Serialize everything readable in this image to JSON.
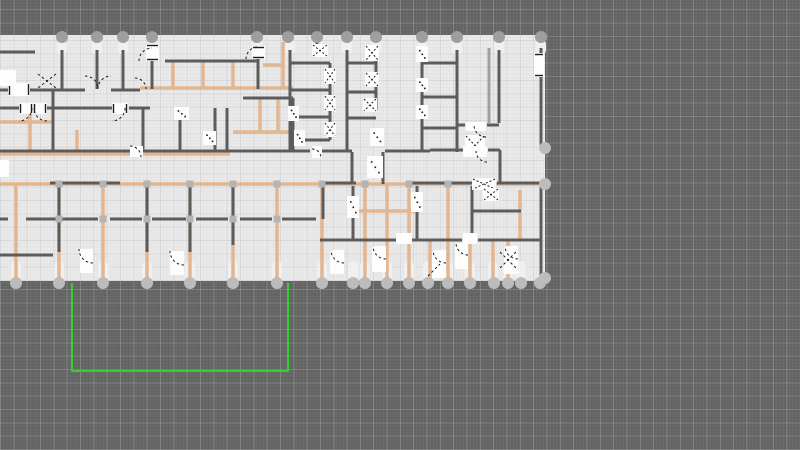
{
  "app": {
    "name": "floor-plan-editor",
    "view": "plan-canvas"
  },
  "canvas": {
    "width": 800,
    "height": 450,
    "background": "#636363",
    "grid": {
      "minor_step_px": 3.33,
      "major_step_px": 13.33,
      "minor_color": "rgba(255,255,255,0.04)",
      "major_color": "rgba(255,255,255,0.16)"
    }
  },
  "slab": {
    "x": 0,
    "y": 35,
    "width": 545,
    "height": 246,
    "fill": "#eaeaea"
  },
  "palette": {
    "wall_dark": "#5c5c5c",
    "wall_light": "#a0a0a0",
    "wall_tan": "#e2b690",
    "door_fill": "#fdfdfd",
    "door_mark": "#1c1c1c",
    "node_top": "#9e9e9e",
    "node_bottom": "#bcbcbc",
    "cap_fill": "#f0f0f0",
    "joint_fill": "#b4b4b4",
    "selection_green": "#2fd12f"
  },
  "geometry": {
    "walls_dark": [
      [
        62,
        50,
        62,
        89
      ],
      [
        97,
        50,
        97,
        89
      ],
      [
        123,
        50,
        123,
        89
      ],
      [
        152,
        60,
        152,
        89
      ],
      [
        165,
        61,
        258,
        61
      ],
      [
        258,
        57,
        258,
        89
      ],
      [
        0,
        52,
        35,
        52
      ],
      [
        290,
        50,
        290,
        152
      ],
      [
        317,
        39,
        317,
        48
      ],
      [
        330,
        63,
        330,
        140
      ],
      [
        290,
        63,
        330,
        63
      ],
      [
        290,
        90,
        330,
        90
      ],
      [
        290,
        117,
        330,
        117
      ],
      [
        290,
        140,
        330,
        140
      ],
      [
        347,
        50,
        347,
        152
      ],
      [
        376,
        50,
        376,
        110
      ],
      [
        347,
        63,
        376,
        63
      ],
      [
        347,
        92,
        376,
        92
      ],
      [
        347,
        118,
        376,
        118
      ],
      [
        422,
        50,
        422,
        152
      ],
      [
        457,
        50,
        457,
        152
      ],
      [
        422,
        63,
        457,
        63
      ],
      [
        422,
        97,
        457,
        97
      ],
      [
        422,
        128,
        457,
        128
      ],
      [
        499,
        50,
        499,
        123
      ],
      [
        541,
        48,
        541,
        148
      ],
      [
        457,
        125,
        465,
        125
      ],
      [
        487,
        125,
        499,
        125
      ],
      [
        430,
        150,
        463,
        150
      ],
      [
        488,
        150,
        500,
        150
      ],
      [
        500,
        150,
        500,
        184
      ],
      [
        541,
        184,
        541,
        281
      ],
      [
        0,
        90,
        9,
        90
      ],
      [
        29,
        90,
        85,
        90
      ],
      [
        111,
        90,
        140,
        90
      ],
      [
        0,
        108,
        19,
        108
      ],
      [
        47,
        108,
        112,
        108
      ],
      [
        129,
        108,
        150,
        108
      ],
      [
        53,
        90,
        53,
        152
      ],
      [
        143,
        108,
        143,
        151
      ],
      [
        180,
        108,
        180,
        151
      ],
      [
        215,
        108,
        215,
        151
      ],
      [
        227,
        108,
        227,
        151
      ],
      [
        243,
        98,
        293,
        98
      ],
      [
        293,
        98,
        293,
        152
      ],
      [
        0,
        151,
        310,
        151
      ],
      [
        321,
        151,
        352,
        151
      ],
      [
        385,
        151,
        430,
        151
      ],
      [
        352,
        152,
        352,
        184
      ],
      [
        383,
        152,
        383,
        184
      ],
      [
        50,
        183,
        120,
        183
      ],
      [
        320,
        183,
        356,
        183
      ],
      [
        412,
        183,
        472,
        183
      ],
      [
        497,
        183,
        540,
        183
      ],
      [
        59,
        186,
        59,
        252
      ],
      [
        147,
        186,
        147,
        252
      ],
      [
        190,
        186,
        190,
        252
      ],
      [
        233,
        186,
        233,
        245
      ],
      [
        323,
        186,
        323,
        219
      ],
      [
        0,
        219,
        8,
        219
      ],
      [
        26,
        219,
        98,
        219
      ],
      [
        110,
        219,
        142,
        219
      ],
      [
        152,
        219,
        186,
        219
      ],
      [
        196,
        219,
        228,
        219
      ],
      [
        240,
        219,
        272,
        219
      ],
      [
        282,
        219,
        316,
        219
      ],
      [
        0,
        255,
        53,
        255
      ],
      [
        353,
        186,
        353,
        240
      ],
      [
        417,
        186,
        417,
        240
      ],
      [
        472,
        186,
        472,
        240
      ],
      [
        320,
        240,
        396,
        240
      ],
      [
        412,
        240,
        462,
        240
      ],
      [
        478,
        240,
        540,
        240
      ],
      [
        472,
        211,
        521,
        211
      ]
    ],
    "walls_tan": [
      [
        173,
        62,
        173,
        88
      ],
      [
        203,
        62,
        203,
        88
      ],
      [
        233,
        62,
        233,
        88
      ],
      [
        283,
        42,
        283,
        88
      ],
      [
        140,
        88,
        293,
        88
      ],
      [
        263,
        65,
        283,
        65
      ],
      [
        30,
        108,
        30,
        152
      ],
      [
        0,
        122,
        52,
        122
      ],
      [
        77,
        130,
        77,
        152
      ],
      [
        260,
        98,
        260,
        132
      ],
      [
        278,
        98,
        278,
        132
      ],
      [
        233,
        132,
        293,
        132
      ],
      [
        0,
        154,
        230,
        154
      ],
      [
        0,
        184,
        545,
        184
      ],
      [
        16,
        184,
        16,
        280
      ],
      [
        59,
        184,
        59,
        280
      ],
      [
        103,
        184,
        103,
        280
      ],
      [
        147,
        184,
        147,
        280
      ],
      [
        190,
        184,
        190,
        280
      ],
      [
        233,
        184,
        233,
        280
      ],
      [
        277,
        184,
        277,
        280
      ],
      [
        322,
        184,
        322,
        280
      ],
      [
        365,
        184,
        365,
        280
      ],
      [
        387,
        184,
        387,
        280
      ],
      [
        409,
        184,
        409,
        280
      ],
      [
        448,
        184,
        448,
        280
      ],
      [
        520,
        190,
        520,
        240
      ],
      [
        430,
        240,
        430,
        280
      ],
      [
        470,
        240,
        470,
        280
      ],
      [
        493,
        240,
        493,
        280
      ],
      [
        508,
        240,
        508,
        280
      ],
      [
        353,
        211,
        417,
        211
      ]
    ],
    "walls_light": [
      [
        489,
        48,
        489,
        123
      ]
    ],
    "joints": [
      [
        59,
        219
      ],
      [
        103,
        219
      ],
      [
        147,
        219
      ],
      [
        190,
        219
      ],
      [
        233,
        219
      ],
      [
        277,
        219
      ],
      [
        59,
        184
      ],
      [
        103,
        184
      ],
      [
        147,
        184
      ],
      [
        190,
        184
      ],
      [
        233,
        184
      ],
      [
        277,
        184
      ],
      [
        322,
        184
      ],
      [
        365,
        184
      ],
      [
        409,
        184
      ],
      [
        448,
        184
      ]
    ],
    "caps_top": [
      62,
      97,
      123,
      152,
      257,
      290,
      317,
      347,
      376,
      422,
      457,
      499,
      541
    ],
    "caps_bottom": [
      16,
      59,
      103,
      147,
      190,
      233,
      277,
      322,
      353,
      365,
      387,
      409,
      428,
      448,
      470,
      493,
      508,
      521
    ],
    "doors": [
      [
        8,
        83,
        22,
        13,
        "ticks"
      ],
      [
        0,
        70,
        16,
        16,
        "none"
      ],
      [
        19,
        103,
        14,
        11,
        "ticks"
      ],
      [
        33,
        103,
        14,
        11,
        "ticks"
      ],
      [
        112,
        103,
        16,
        11,
        "ticks"
      ],
      [
        146,
        44,
        13,
        17,
        "ticks"
      ],
      [
        252,
        46,
        13,
        13,
        "ticks"
      ],
      [
        174,
        107,
        15,
        13,
        "dots"
      ],
      [
        203,
        131,
        13,
        14,
        "dots"
      ],
      [
        288,
        106,
        11,
        15,
        "dots"
      ],
      [
        312,
        44,
        16,
        13,
        "x"
      ],
      [
        324,
        68,
        12,
        16,
        "x"
      ],
      [
        324,
        95,
        12,
        16,
        "x"
      ],
      [
        324,
        122,
        12,
        15,
        "x"
      ],
      [
        365,
        45,
        14,
        16,
        "x"
      ],
      [
        365,
        72,
        14,
        15,
        "x"
      ],
      [
        363,
        98,
        14,
        14,
        "x"
      ],
      [
        416,
        46,
        12,
        16,
        "dots"
      ],
      [
        416,
        78,
        12,
        14,
        "dots"
      ],
      [
        416,
        105,
        12,
        14,
        "dots"
      ],
      [
        466,
        122,
        20,
        9,
        "none"
      ],
      [
        465,
        135,
        20,
        21,
        "x"
      ],
      [
        534,
        53,
        10,
        24,
        "ticks"
      ],
      [
        130,
        146,
        13,
        11,
        "none"
      ],
      [
        312,
        146,
        10,
        12,
        "none"
      ],
      [
        367,
        156,
        16,
        22,
        "dots"
      ],
      [
        370,
        128,
        14,
        18,
        "dots"
      ],
      [
        463,
        146,
        24,
        11,
        "none"
      ],
      [
        0,
        160,
        9,
        17,
        "none"
      ],
      [
        472,
        178,
        24,
        12,
        "x"
      ],
      [
        347,
        196,
        12,
        22,
        "dots"
      ],
      [
        411,
        192,
        12,
        20,
        "dots"
      ],
      [
        396,
        233,
        16,
        11,
        "none"
      ],
      [
        463,
        233,
        14,
        11,
        "none"
      ],
      [
        80,
        249,
        13,
        24,
        "none"
      ],
      [
        170,
        251,
        14,
        24,
        "none"
      ],
      [
        330,
        250,
        14,
        24,
        "none"
      ],
      [
        372,
        246,
        14,
        26,
        "none"
      ],
      [
        432,
        250,
        14,
        28,
        "none"
      ],
      [
        455,
        243,
        13,
        26,
        "none"
      ],
      [
        504,
        246,
        14,
        28,
        "none"
      ],
      [
        483,
        188,
        16,
        13,
        "x"
      ],
      [
        294,
        130,
        11,
        16,
        "dots"
      ]
    ],
    "arcs": [
      [
        85,
        89,
        13,
        270,
        360
      ],
      [
        111,
        89,
        13,
        180,
        270
      ],
      [
        135,
        89,
        11,
        270,
        360
      ],
      [
        19,
        108,
        13,
        0,
        90
      ],
      [
        47,
        108,
        13,
        90,
        180
      ],
      [
        112,
        108,
        13,
        0,
        90
      ],
      [
        152,
        61,
        13,
        180,
        270
      ],
      [
        258,
        59,
        12,
        180,
        270
      ],
      [
        130,
        157,
        11,
        270,
        360
      ],
      [
        312,
        158,
        9,
        270,
        360
      ],
      [
        486,
        125,
        12,
        90,
        180
      ],
      [
        487,
        151,
        11,
        90,
        180
      ],
      [
        93,
        249,
        14,
        90,
        180
      ],
      [
        184,
        251,
        14,
        90,
        180
      ],
      [
        344,
        250,
        13,
        90,
        180
      ],
      [
        386,
        246,
        13,
        90,
        180
      ],
      [
        446,
        250,
        13,
        90,
        180
      ],
      [
        468,
        243,
        12,
        90,
        180
      ],
      [
        518,
        246,
        13,
        90,
        180
      ]
    ],
    "xmarks": [
      [
        38,
        74,
        56,
        88
      ],
      [
        56,
        74,
        38,
        88
      ],
      [
        500,
        252,
        516,
        268
      ],
      [
        516,
        252,
        500,
        268
      ],
      [
        428,
        276,
        440,
        264
      ]
    ],
    "nodes_top_y": 37,
    "nodes_top": [
      62,
      97,
      123,
      152,
      257,
      288,
      317,
      347,
      376,
      422,
      457,
      499,
      541
    ],
    "nodes_bottom_y": 283,
    "nodes_bottom": [
      16,
      59,
      103,
      147,
      190,
      233,
      277,
      322,
      353,
      365,
      387,
      409,
      428,
      448,
      470,
      494,
      508,
      521,
      540
    ],
    "nodes_right": [
      [
        545,
        148
      ],
      [
        545,
        184
      ],
      [
        545,
        278
      ]
    ]
  },
  "selection": {
    "x1": 72,
    "y1": 283,
    "x2": 288,
    "y2": 371,
    "color": "#2fd12f",
    "stroke_width": 2
  }
}
